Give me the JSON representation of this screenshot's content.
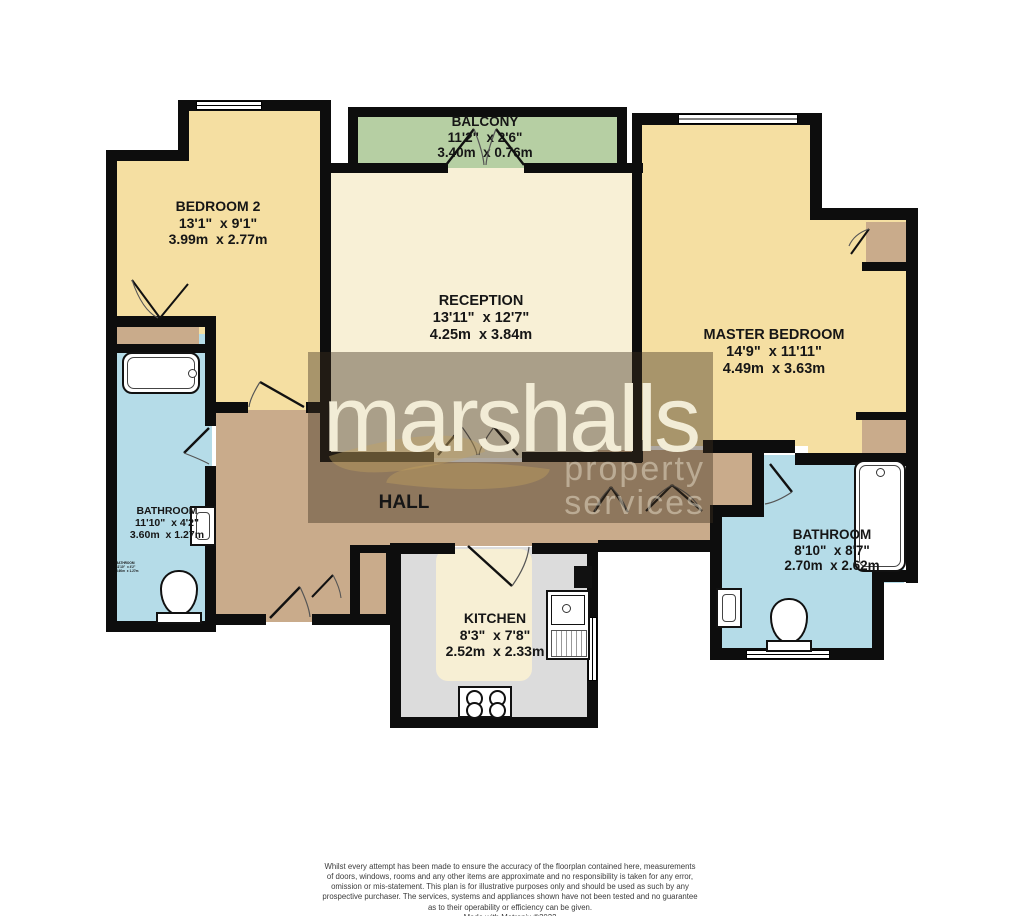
{
  "palette": {
    "wall": "#0d0d0d",
    "bedroom": "#f5dfa2",
    "reception": "#f8f0d6",
    "balcony": "#b6cfa3",
    "bathroom": "#b5dce8",
    "hall": "#c9ab8b",
    "kitchen": "#dcdcdc",
    "kitchen-inner": "#f7efd4",
    "overlay": "rgba(62,47,31,0.42)",
    "brand-text": "#f2ecd6",
    "tagline-text": "rgba(242,236,214,0.45)"
  },
  "watermark": {
    "brand": "marshalls",
    "tagline": "property services"
  },
  "rooms": {
    "balcony": {
      "name": "BALCONY",
      "imperial": "11'2\"  x 2'6\"",
      "metric": "3.40m  x 0.76m"
    },
    "bedroom2": {
      "name": "BEDROOM 2",
      "imperial": "13'1\"  x 9'1\"",
      "metric": "3.99m  x 2.77m"
    },
    "reception": {
      "name": "RECEPTION",
      "imperial": "13'11\"  x 12'7\"",
      "metric": "4.25m  x 3.84m"
    },
    "master": {
      "name": "MASTER BEDROOM",
      "imperial": "14'9\"  x 11'11\"",
      "metric": "4.49m  x 3.63m"
    },
    "bathroom_left": {
      "name": "BATHROOM",
      "imperial": "11'10\"  x 4'2\"",
      "metric": "3.60m  x 1.27m"
    },
    "hall": {
      "name": "HALL"
    },
    "kitchen": {
      "name": "KITCHEN",
      "imperial": "8'3\"  x 7'8\"",
      "metric": "2.52m  x 2.33m"
    },
    "bathroom_right": {
      "name": "BATHROOM",
      "imperial": "8'10\"  x 8'7\"",
      "metric": "2.70m  x 2.62m"
    }
  },
  "footer": {
    "lines": [
      "Whilst every attempt has been made to ensure the accuracy of the floorplan contained here, measurements",
      "of doors, windows, rooms and any other items are approximate and no responsibility is taken for any error,",
      "omission or mis-statement. This plan is for illustrative purposes only and should be used as such by any",
      "prospective purchaser. The services, systems and appliances shown have not been tested and no guarantee",
      "as to their operability or efficiency can be given."
    ],
    "credit": "Made with Metropix ©2022"
  }
}
